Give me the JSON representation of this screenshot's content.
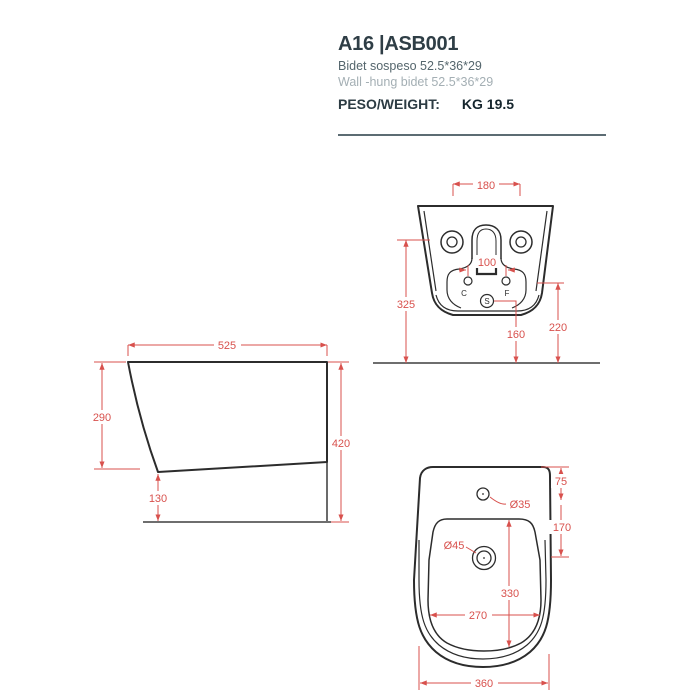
{
  "header": {
    "title": "A16 |ASB001",
    "subtitle_it": "Bidet sospeso 52.5*36*29",
    "subtitle_en": "Wall -hung bidet 52.5*36*29",
    "weight_label": "PESO/WEIGHT:",
    "weight_value": "KG 19.5"
  },
  "colors": {
    "dimension_red": "#d8514d",
    "outline_dark": "#2c2c2c",
    "title_dark": "#2f3e46",
    "separator_gray": "#5c6c73"
  },
  "dims": {
    "rear_holes_spacing": "180",
    "rear_cf_spacing": "100",
    "rear_holes_to_floor": "325",
    "rear_drain_to_floor": "160",
    "rear_cf_to_floor": "220",
    "cold_label": "C",
    "hot_label": "F",
    "drain_label": "S",
    "side_depth": "525",
    "side_front_height": "290",
    "side_clearance": "130",
    "side_total_height": "420",
    "top_tap_hole_dia": "Ø35",
    "top_drain_dia": "Ø45",
    "top_rim_to_tap": "75",
    "top_tap_to_drain": "170",
    "top_basin_length": "330",
    "top_basin_width": "270",
    "top_overall_width": "360"
  }
}
